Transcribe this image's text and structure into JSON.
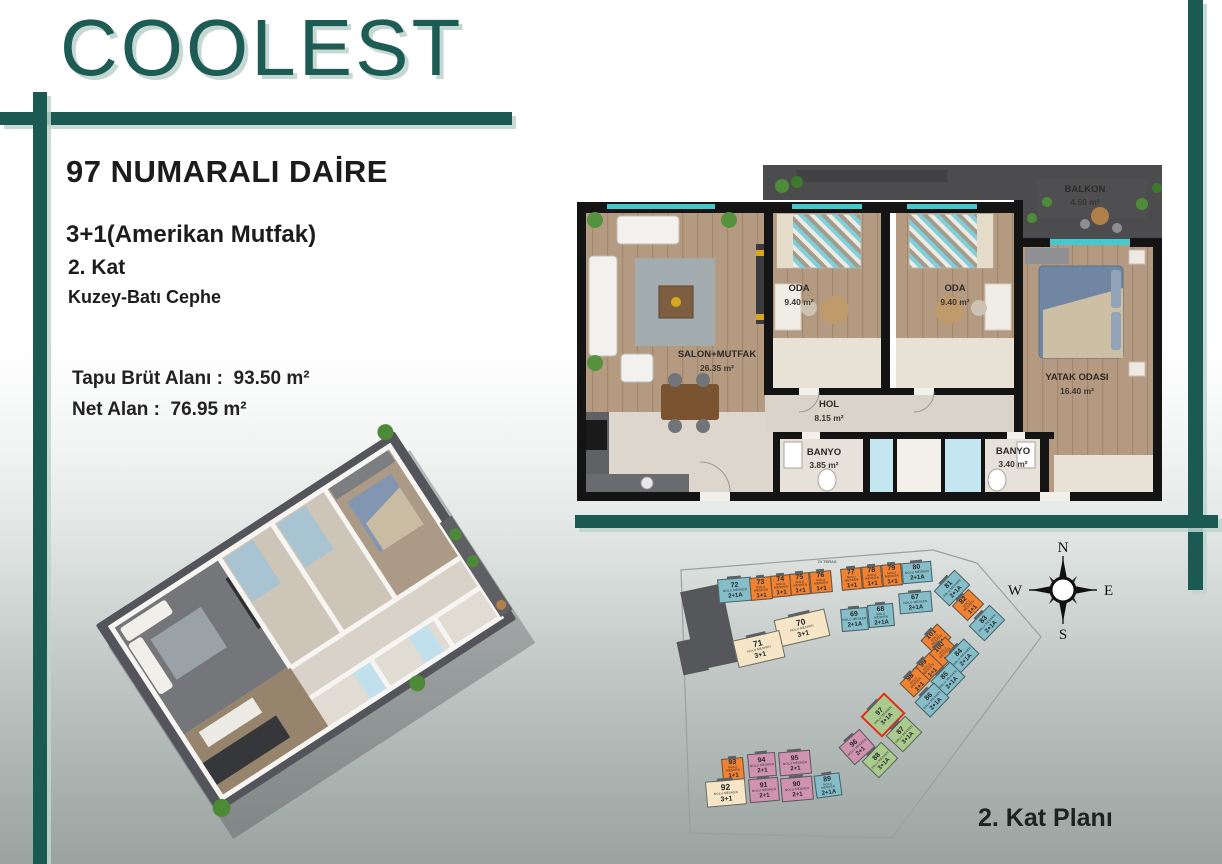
{
  "brand": {
    "logo_text": "COOLEST"
  },
  "colors": {
    "accent_teal": "#1b5a52",
    "bar_shadow": "#c6d8d2",
    "highlight_red": "#e62b1e",
    "unit_teal": "#85bdc9",
    "unit_orange": "#f08232",
    "unit_cream": "#f6e6c6",
    "unit_pink": "#cf93b0",
    "unit_green": "#abca8e"
  },
  "info": {
    "title": "97 NUMARALI DAİRE",
    "plan_type": "3+1(Amerikan Mutfak)",
    "floor": "2. Kat",
    "facade": "Kuzey-Batı Cephe",
    "gross_label": "Tapu Brüt Alanı :",
    "gross_value": "93.50 m²",
    "net_label": "Net Alan :",
    "net_value": "76.95 m²"
  },
  "floor_plan": {
    "rooms": {
      "salon": {
        "name": "SALON+MUTFAK",
        "area": "26.35 m²"
      },
      "oda1": {
        "name": "ODA",
        "area": "9.40 m²"
      },
      "oda2": {
        "name": "ODA",
        "area": "9.40 m²"
      },
      "yatak": {
        "name": "YATAK ODASI",
        "area": "16.40 m²"
      },
      "hol": {
        "name": "HOL",
        "area": "8.15 m²"
      },
      "banyo1": {
        "name": "BANYO",
        "area": "3.85 m²"
      },
      "banyo2": {
        "name": "BANYO",
        "area": "3.40 m²"
      },
      "balkon": {
        "name": "BALKON",
        "area": "4.50 m²"
      }
    }
  },
  "site_plan": {
    "title": "2. Kat Planı",
    "unit_subtitle": "NOLU MESKEN",
    "teras_label": "74 TERAS",
    "highlighted_unit": "97",
    "compass": {
      "n": "N",
      "e": "E",
      "s": "S",
      "w": "W"
    },
    "units": [
      {
        "no": "72",
        "type": "2+1A",
        "color": "teal"
      },
      {
        "no": "73",
        "type": "1+1",
        "color": "orange"
      },
      {
        "no": "74",
        "type": "1+1",
        "color": "orange"
      },
      {
        "no": "75",
        "type": "1+1",
        "color": "orange"
      },
      {
        "no": "76",
        "type": "1+1",
        "color": "orange"
      },
      {
        "no": "77",
        "type": "1+1",
        "color": "orange"
      },
      {
        "no": "78",
        "type": "1+1",
        "color": "orange"
      },
      {
        "no": "79",
        "type": "1+1",
        "color": "orange"
      },
      {
        "no": "80",
        "type": "2+1A",
        "color": "teal"
      },
      {
        "no": "69",
        "type": "2+1A",
        "color": "teal"
      },
      {
        "no": "68",
        "type": "2+1A",
        "color": "teal"
      },
      {
        "no": "67",
        "type": "2+1A",
        "color": "teal"
      },
      {
        "no": "70",
        "type": "3+1",
        "color": "cream"
      },
      {
        "no": "71",
        "type": "3+1",
        "color": "cream"
      },
      {
        "no": "81",
        "type": "2+1A",
        "color": "teal"
      },
      {
        "no": "82",
        "type": "1+1",
        "color": "orange"
      },
      {
        "no": "83",
        "type": "2+1A",
        "color": "teal"
      },
      {
        "no": "101",
        "type": "1+1",
        "color": "orange"
      },
      {
        "no": "100",
        "type": "1+1",
        "color": "orange"
      },
      {
        "no": "84",
        "type": "2+1A",
        "color": "teal"
      },
      {
        "no": "99",
        "type": "1+1",
        "color": "orange"
      },
      {
        "no": "85",
        "type": "2+1A",
        "color": "teal"
      },
      {
        "no": "98",
        "type": "1+1",
        "color": "orange"
      },
      {
        "no": "86",
        "type": "2+1A",
        "color": "teal"
      },
      {
        "no": "97",
        "type": "3+1A",
        "color": "green",
        "highlight": true
      },
      {
        "no": "87",
        "type": "3+1A",
        "color": "green"
      },
      {
        "no": "96",
        "type": "2+1",
        "color": "pink"
      },
      {
        "no": "88",
        "type": "3+1A",
        "color": "green"
      },
      {
        "no": "93",
        "type": "1+1",
        "color": "orange"
      },
      {
        "no": "94",
        "type": "2+1",
        "color": "pink"
      },
      {
        "no": "95",
        "type": "2+1",
        "color": "pink"
      },
      {
        "no": "92",
        "type": "3+1",
        "color": "cream"
      },
      {
        "no": "91",
        "type": "2+1",
        "color": "pink"
      },
      {
        "no": "90",
        "type": "2+1",
        "color": "pink"
      },
      {
        "no": "89",
        "type": "2+1A",
        "color": "teal"
      }
    ]
  }
}
